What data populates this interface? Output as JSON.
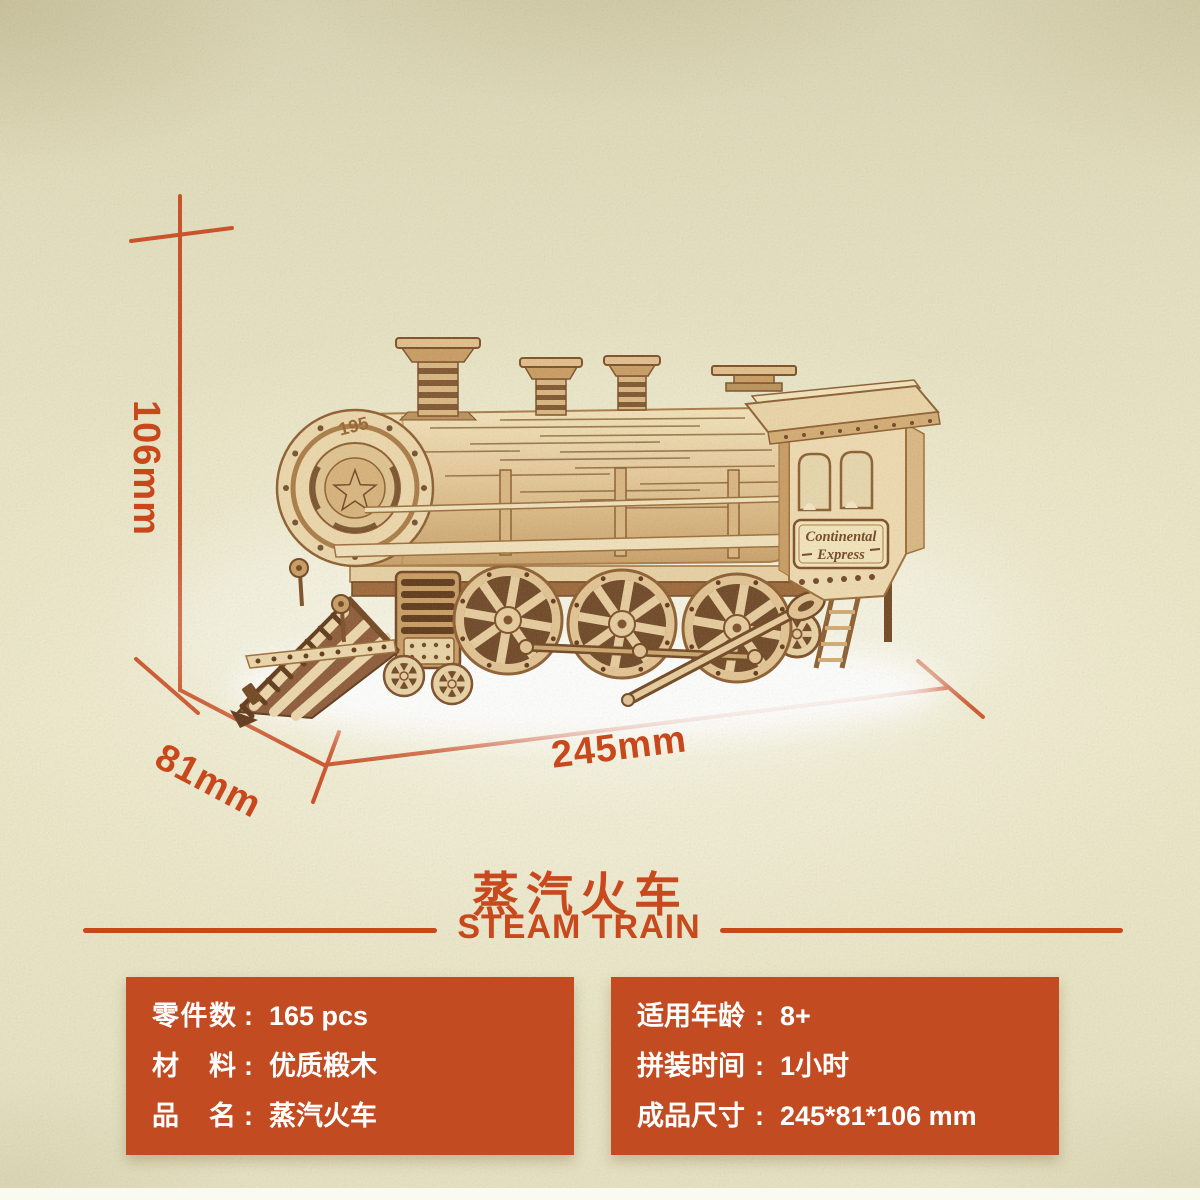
{
  "colors": {
    "accent_red": "#c8481c",
    "spec_box_bg": "#c24b22",
    "spec_text": "#ffffff",
    "paper_beige": "#e9e4c2",
    "wood_light": "#ecd6a8",
    "wood_dark": "#6e421c"
  },
  "dimensions": {
    "height": "106mm",
    "depth": "81mm",
    "width": "245mm"
  },
  "title": {
    "zh": "蒸汽火车",
    "en": "STEAM TRAIN"
  },
  "train": {
    "front_number": "195",
    "sign_line1": "Continental",
    "sign_line2": "Express"
  },
  "specs": {
    "colon": ":",
    "left": [
      {
        "label": "零件数",
        "value": "165 pcs"
      },
      {
        "label": "材料",
        "value": "优质椴木"
      },
      {
        "label": "品名",
        "value": "蒸汽火车"
      }
    ],
    "right": [
      {
        "label": "适用年龄",
        "value": "8+"
      },
      {
        "label": "拼装时间",
        "value": "1小时"
      },
      {
        "label": "成品尺寸",
        "value": "245*81*106 mm"
      }
    ]
  }
}
